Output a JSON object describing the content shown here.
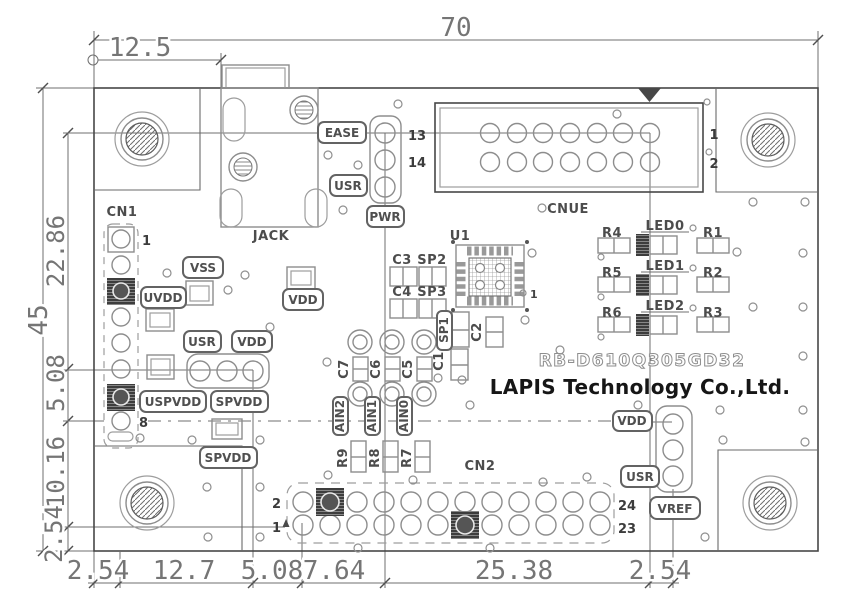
{
  "dimensions": {
    "top": {
      "board_width": "70",
      "usb_offset": "12.5"
    },
    "left": {
      "board_height": "45",
      "segments": [
        "22.86",
        "5.08",
        "10.16",
        "2.54"
      ]
    },
    "bottom": {
      "segments": [
        "2.54",
        "12.7",
        "5.08",
        "7.64",
        "25.38",
        "2.54"
      ]
    }
  },
  "branding": {
    "model": "RB-D610Q305GD32",
    "company": "LAPIS Technology Co.,Ltd."
  },
  "connectors": {
    "cn1": {
      "ref": "CN1",
      "pin1": "1",
      "pin8": "8"
    },
    "jack": {
      "ref": "JACK"
    },
    "cnue": {
      "ref": "CNUE",
      "pin13": "13",
      "pin14": "14",
      "pin1": "1",
      "pin2": "2"
    },
    "cn2": {
      "ref": "CN2",
      "pin2": "2",
      "pin1": "1",
      "pin24": "24",
      "pin23": "23"
    },
    "u1": {
      "ref": "U1",
      "pin1": "1"
    }
  },
  "silkscreen": {
    "ease": "EASE",
    "usr_top": "USR",
    "pwr": "PWR",
    "vss": "VSS",
    "uvdd": "UVDD",
    "vdd_a": "VDD",
    "usr_mid": "USR",
    "vdd_b": "VDD",
    "uspvdd": "USPVDD",
    "spvdd_a": "SPVDD",
    "spvdd_b": "SPVDD",
    "vdd_right": "VDD",
    "usr_right": "USR",
    "vref": "VREF",
    "ain2": "AIN2",
    "ain1": "AIN1",
    "ain0": "AIN0",
    "sp1": "SP1"
  },
  "components": {
    "c1": "C1",
    "c2": "C2",
    "c3": "C3",
    "c4": "C4",
    "c5": "C5",
    "c6": "C6",
    "c7": "C7",
    "sp2": "SP2",
    "sp3": "SP3",
    "r1": "R1",
    "r2": "R2",
    "r3": "R3",
    "r4": "R4",
    "r5": "R5",
    "r6": "R6",
    "r7": "R7",
    "r8": "R8",
    "r9": "R9",
    "led0": "LED0",
    "led1": "LED1",
    "led2": "LED2"
  }
}
